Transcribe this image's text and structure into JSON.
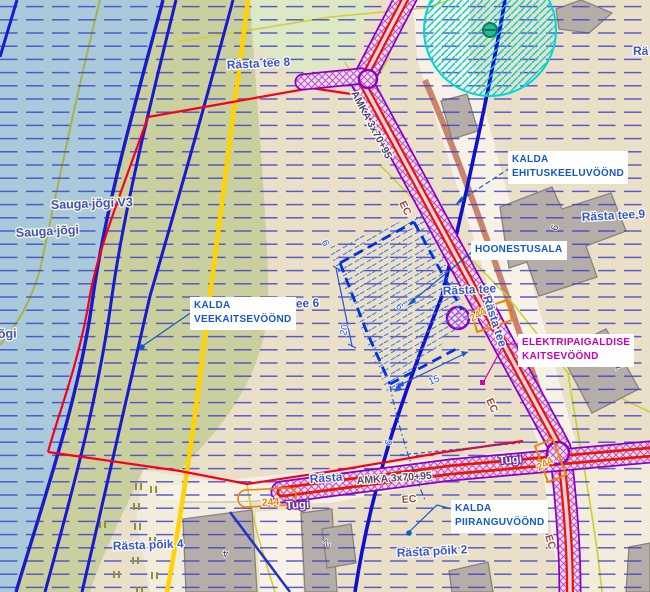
{
  "map": {
    "annotations": {
      "ehituskeeluvoond": {
        "line1": "KALDA",
        "line2": "EHITUSKEELUVÖÖND"
      },
      "hoonestusala": {
        "line1": "HOONESTUSALA"
      },
      "veekaitsevoond": {
        "line1": "KALDA",
        "line2": "VEEKAITSEVÖÖND"
      },
      "elektripaigaldise": {
        "line1": "ELEKTRIPAIGALDISE",
        "line2": "KAITSEVÖÖND"
      },
      "piiranguvoond": {
        "line1": "KALDA",
        "line2": "PIIRANGUVÖÖND"
      }
    },
    "streets": {
      "rasta_tee_8": "Rästa tee 8",
      "rasta_tee_9": "Rästa tee 9",
      "rasta_tee_6": "Rästa tee 6",
      "rasta_tee": "Rästa tee",
      "rasta_partial": "Rästa",
      "ra_partial": "Rä",
      "rasta_poik_4": "Rästa põik 4",
      "rasta_poik_2": "Rästa põik 2"
    },
    "water": {
      "sauga_jogi": "Sauga jõgi",
      "sauga_jogi_v": "Sauga jõgi V3",
      "jogi_partial": "õgi"
    },
    "utilities": {
      "cable": "AMKA 3x70+95",
      "ec": "EC",
      "tugi": "Tugi",
      "pylon": "244"
    },
    "dimensions": {
      "d20": "20",
      "d15": "15",
      "d9": "9",
      "d6": "6"
    },
    "building_numbers": {
      "n9": "9",
      "n1": "1",
      "n4": "4",
      "n2": "2"
    },
    "colors": {
      "water": "#a9cadb",
      "bank": "#c9d09e",
      "land": "#eae0c8",
      "grid_line": "#4040c8",
      "boundary_red": "#f5001e",
      "zone_blue": "#1a1acd",
      "corridor_purple": "#8a00c8",
      "corridor_red": "#ee1500",
      "road_yellow": "#ffd200",
      "annotation_blue": "#1558c8",
      "annotation_magenta": "#cc00b4",
      "cyan_zone": "#00d6d6",
      "pylon_orange": "#f08400"
    }
  }
}
